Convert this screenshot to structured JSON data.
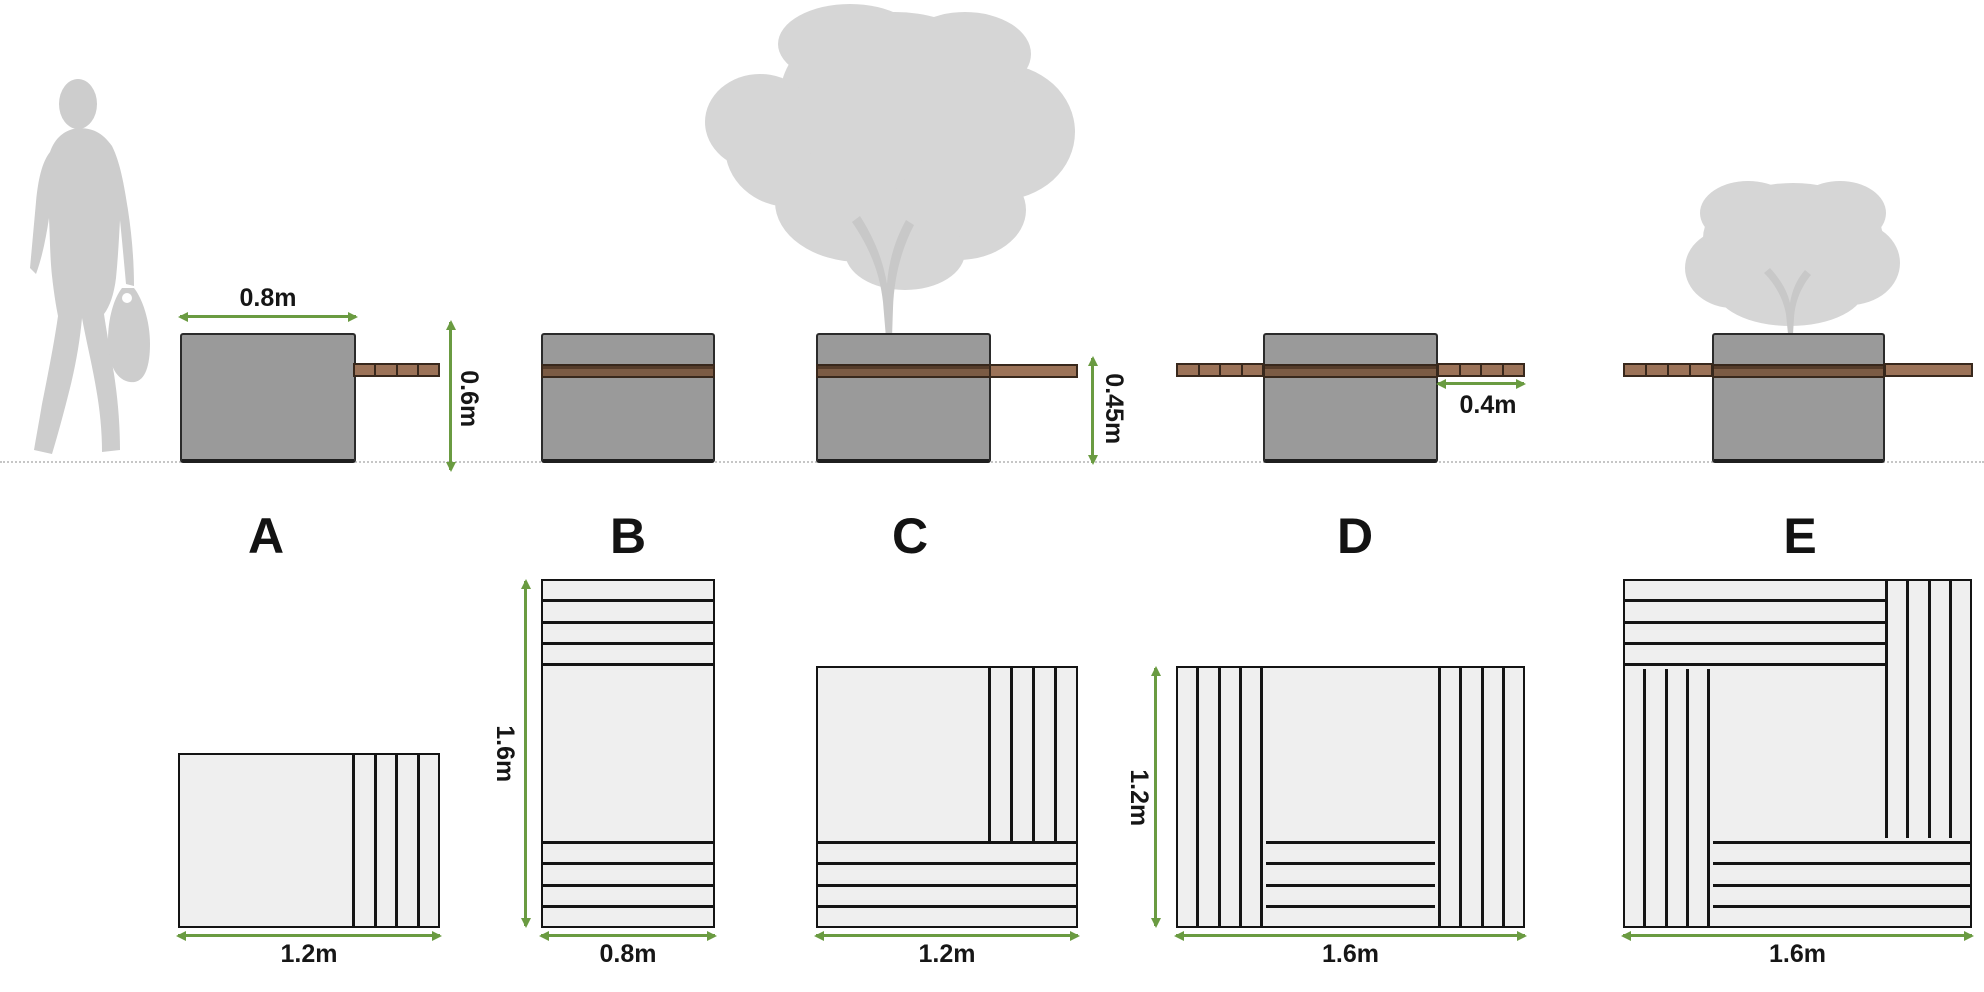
{
  "options": [
    {
      "label": "A"
    },
    {
      "label": "B"
    },
    {
      "label": "C"
    },
    {
      "label": "D"
    },
    {
      "label": "E"
    }
  ],
  "elevation_dims": {
    "a_width": "0.8m",
    "a_height": "0.6m",
    "c_seat_height": "0.45m",
    "d_bench_overhang": "0.4m"
  },
  "plan_dims": {
    "a_width": "1.2m",
    "b_height": "1.6m",
    "b_width": "0.8m",
    "c_width": "1.2m",
    "d_height": "1.2m",
    "d_width": "1.6m",
    "e_width": "1.6m"
  },
  "colors": {
    "dimension_green": "#6a9b41",
    "planter_grey": "#9a9a9a",
    "bench_dark_brown": "#7b5b44",
    "bench_light_brown": "#9c7358",
    "plan_fill": "#efefef",
    "plan_line": "#141414",
    "silhouette_grey": "#cdcdcd"
  }
}
